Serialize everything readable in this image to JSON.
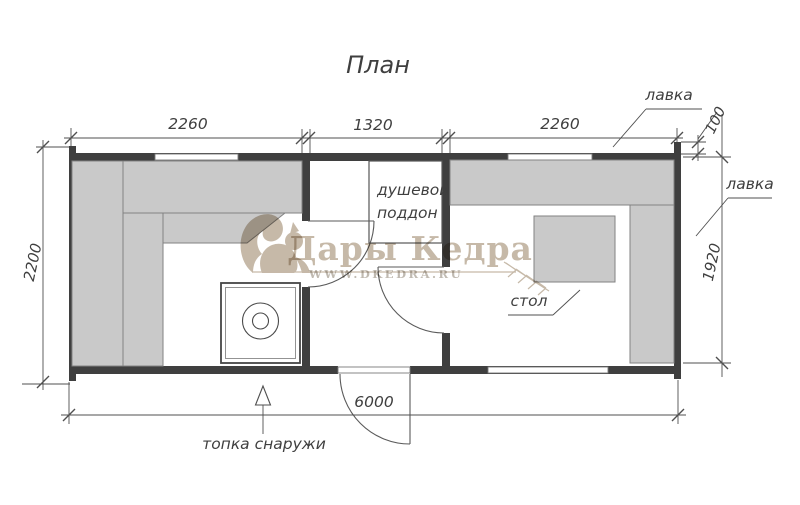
{
  "title": "План",
  "colors": {
    "wall": "#3f3f3f",
    "bench": "#c9c9c9",
    "benchline": "#828282",
    "winline": "#7a7a7a",
    "line": "#4f4f4f",
    "thin": "#5a5a5a",
    "text": "#3f3f3f",
    "wm": "#c6b9a8",
    "wmurl": "#c0bab1"
  },
  "dims": {
    "w_left": "2260",
    "w_mid": "1320",
    "w_right": "2260",
    "corner": "100",
    "h_left": "2200",
    "h_right": "1920",
    "total": "6000"
  },
  "labels": {
    "bench_top": "лавка",
    "bench_right": "лавка",
    "shower_1": "душевой",
    "shower_2": "поддон",
    "table": "стол",
    "stove_outside": "топка снаружи"
  },
  "watermark": {
    "brand": "Дары Кедра",
    "url": "WWW.DKEDRA.RU"
  }
}
